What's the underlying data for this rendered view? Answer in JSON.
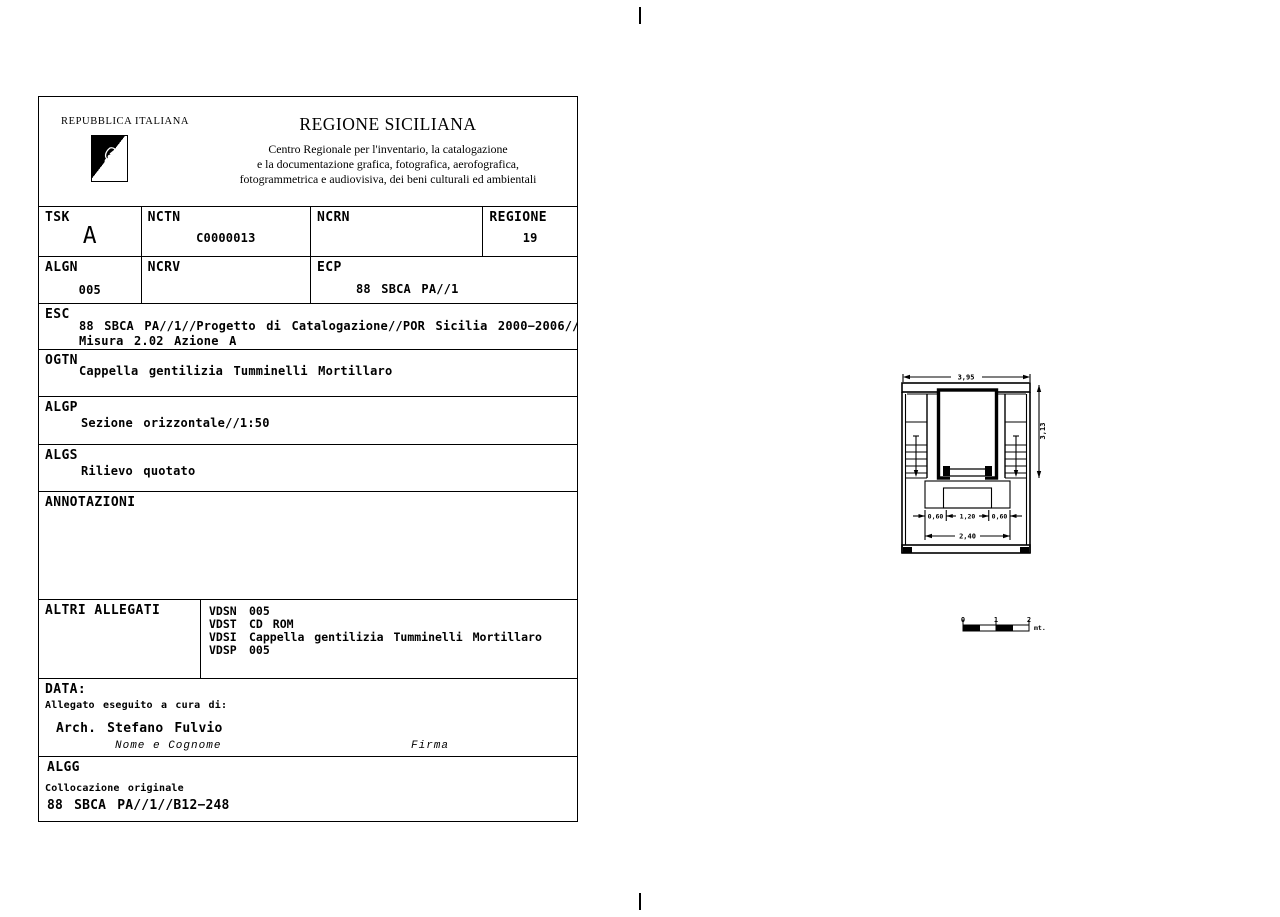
{
  "header": {
    "republic": "REPUBBLICA ITALIANA",
    "title": "REGIONE SICILIANA",
    "subtitle1": "Centro Regionale per l'inventario, la catalogazione",
    "subtitle2": "e la documentazione grafica, fotografica, aerofografica,",
    "subtitle3": "fotogrammetrica e audiovisiva, dei beni culturali ed ambientali"
  },
  "fields": {
    "tsk": {
      "label": "TSK",
      "value": "A"
    },
    "nctn": {
      "label": "NCTN",
      "value": "C0000013"
    },
    "ncrn": {
      "label": "NCRN",
      "value": ""
    },
    "regione": {
      "label": "REGIONE",
      "value": "19"
    },
    "algn": {
      "label": "ALGN",
      "value": "005"
    },
    "ncrv": {
      "label": "NCRV",
      "value": ""
    },
    "ecp": {
      "label": "ECP",
      "value": "88 SBCA PA//1"
    },
    "esc": {
      "label": "ESC",
      "line1": "88 SBCA PA//1//Progetto di Catalogazione//POR Sicilia 2000−2006//",
      "line2": "Misura 2.02 Azione A"
    },
    "ogtn": {
      "label": "OGTN",
      "value": "Cappella gentilizia Tumminelli Mortillaro"
    },
    "algp": {
      "label": "ALGP",
      "value": "Sezione orizzontale//1:50"
    },
    "algs": {
      "label": "ALGS",
      "value": "Rilievo quotato"
    },
    "annotazioni": {
      "label": "ANNOTAZIONI"
    },
    "altri_allegati": {
      "label": "ALTRI ALLEGATI",
      "rows": [
        {
          "key": "VDSN",
          "value": "005"
        },
        {
          "key": "VDST",
          "value": "CD ROM"
        },
        {
          "key": "VDSI",
          "value": "Cappella gentilizia Tumminelli Mortillaro"
        },
        {
          "key": "VDSP",
          "value": "005"
        }
      ]
    },
    "data_section": {
      "label": "DATA:",
      "caption": "Allegato eseguito a cura di:",
      "name": "Arch. Stefano Fulvio",
      "name_caption": "Nome e Cognome",
      "firma_caption": "Firma"
    },
    "algg": {
      "label": "ALGG",
      "caption": "Collocazione originale",
      "value": "88 SBCA PA//1//B12−248"
    }
  },
  "drawing": {
    "dims": {
      "width_top": "3,95",
      "height_right": "3,13",
      "bottom_left": "0,60",
      "bottom_center": "1,20",
      "bottom_right": "0,60",
      "bottom_total": "2,40"
    },
    "scale_bar": {
      "t0": "0",
      "t1": "1",
      "t2": "2",
      "unit": "mt."
    }
  }
}
